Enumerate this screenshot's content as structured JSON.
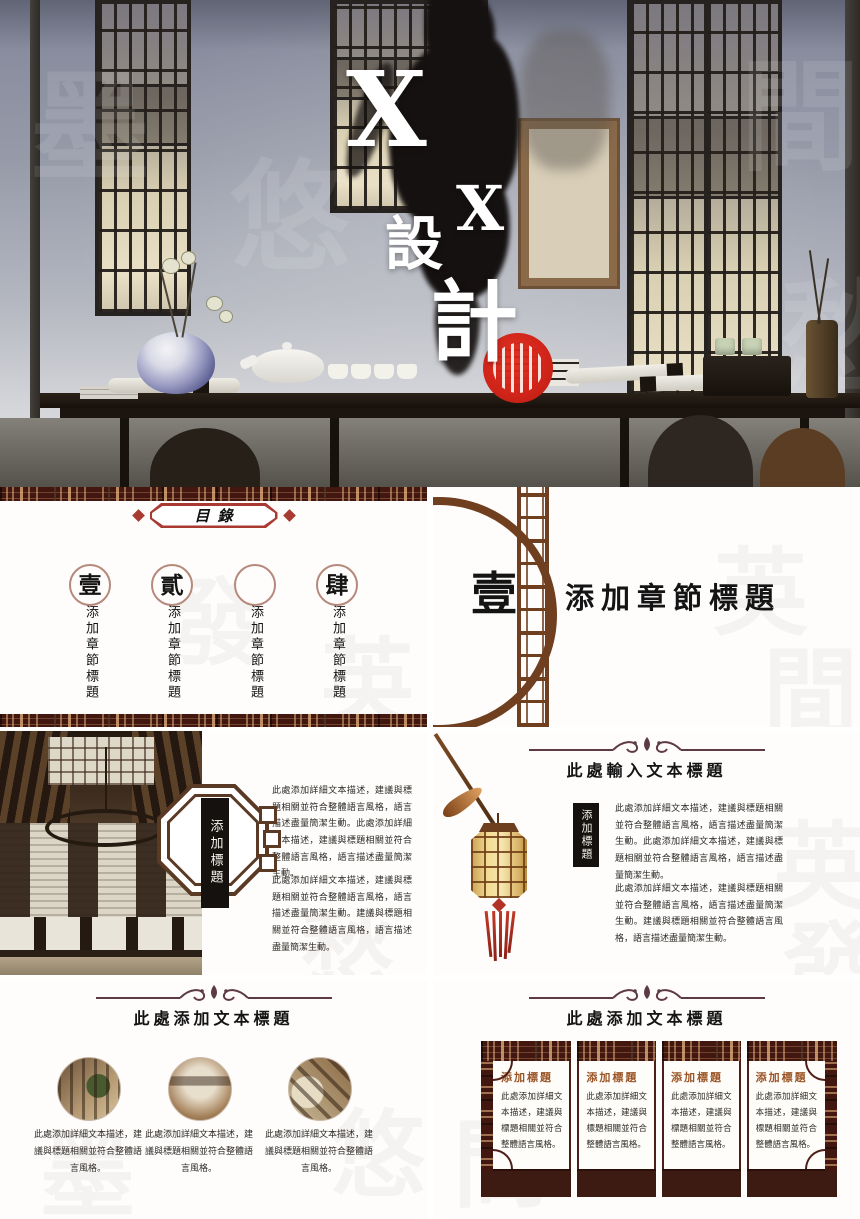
{
  "colors": {
    "maroon": "#41170f",
    "border_red": "#a93a32",
    "seal_red": "#d2251a",
    "lattice_brown": "#6f3f1f",
    "panel_title_brown": "#9a5526",
    "ink_black": "#151110"
  },
  "cover": {
    "char1": "X",
    "char2": "X",
    "char3": "設",
    "char4": "計"
  },
  "toc": {
    "header": "目錄",
    "items": [
      {
        "num": "壹",
        "label": "添加章節標題"
      },
      {
        "num": "貳",
        "label": "添加章節標題"
      },
      {
        "num": "",
        "label": "添加章節標題"
      },
      {
        "num": "肆",
        "label": "添加章節標題"
      }
    ]
  },
  "section": {
    "num": "壹",
    "title": "添加章節標題"
  },
  "interior": {
    "side_label": "添加標題",
    "para1": "此處添加詳細文本描述，建議與標題相關並符合整體語言風格，語言描述盡量簡潔生動。此處添加詳細文本描述，建議與標題相關並符合整體語言風格，語言描述盡量簡潔生動。",
    "para2": "此處添加詳細文本描述，建議與標題相關並符合整體語言風格，語言描述盡量簡潔生動。建議與標題相關並符合整體語言風格，語言描述盡量簡潔生動。"
  },
  "lantern": {
    "title": "此處輸入文本標題",
    "side_label": "添加標題",
    "para1": "此處添加詳細文本描述，建議與標題相關並符合整體語言風格，語言描述盡量簡潔生動。此處添加詳細文本描述，建議與標題相關並符合整體語言風格，語言描述盡量簡潔生動。",
    "para2": "此處添加詳細文本描述，建議與標題相關並符合整體語言風格，語言描述盡量簡潔生動。建議與標題相關並符合整體語言風格，語言描述盡量簡潔生動。"
  },
  "gallery": {
    "title": "此處添加文本標題",
    "captions": [
      "此處添加詳細文本描述，建議與標題相關並符合整體語言風格。",
      "此處添加詳細文本描述，建議與標題相關並符合整體語言風格。",
      "此處添加詳細文本描述，建議與標題相關並符合整體語言風格。"
    ]
  },
  "panels": {
    "title": "此處添加文本標題",
    "items": [
      {
        "title": "添加標題",
        "text": "此處添加詳細文本描述，建議與標題相關並符合整體語言風格。"
      },
      {
        "title": "添加標題",
        "text": "此處添加詳細文本描述，建議與標題相關並符合整體語言風格。"
      },
      {
        "title": "添加標題",
        "text": "此處添加詳細文本描述，建議與標題相關並符合整體語言風格。"
      },
      {
        "title": "添加標題",
        "text": "此處添加詳細文本描述，建議與標題相關並符合整體語言風格。"
      }
    ]
  },
  "background": {
    "chars": [
      "英",
      "間",
      "發",
      "墨",
      "悠",
      "愁"
    ]
  }
}
